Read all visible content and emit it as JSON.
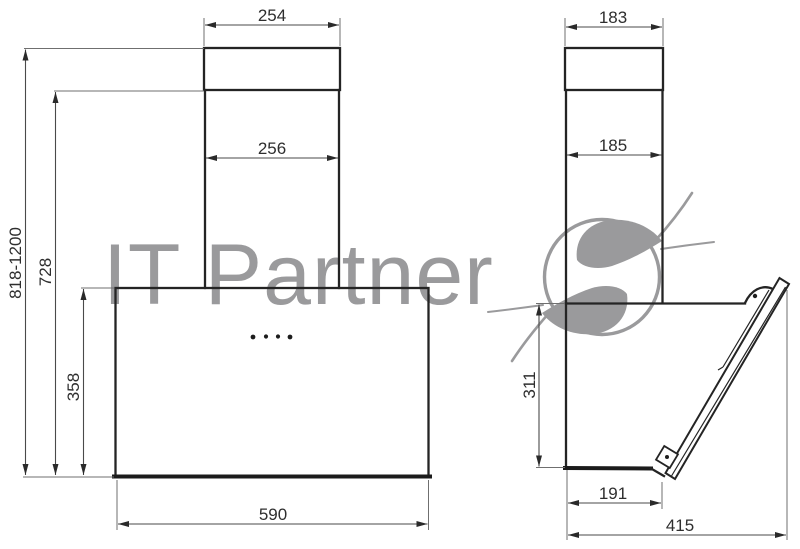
{
  "watermark": {
    "brand_text": "IT Partner",
    "logo": "s-swoosh-logo"
  },
  "colors": {
    "watermark": "#9a9a9c",
    "line": "#242424",
    "dim_line": "#4a4a4a"
  },
  "front_view": {
    "name": "front view of cooker hood",
    "dims": {
      "top_duct_width": "254",
      "duct_width": "256",
      "total_height_range": "818-1200",
      "upper_height": "728",
      "body_height": "358",
      "body_width": "590"
    }
  },
  "side_view": {
    "name": "side view of cooker hood",
    "dims": {
      "top_duct_depth": "183",
      "duct_depth": "185",
      "body_height": "311",
      "body_bottom_depth": "191",
      "total_depth": "415"
    }
  }
}
